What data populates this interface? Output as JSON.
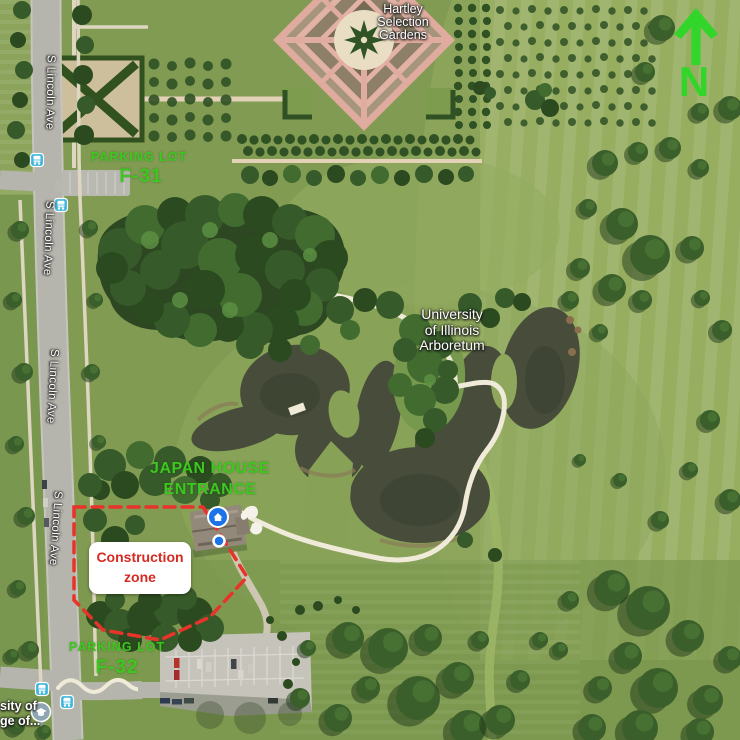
{
  "labels": {
    "hartley": {
      "l1": "Hartley",
      "l2": "Selection",
      "l3": "Gardens"
    },
    "arboretum": {
      "l1": "University",
      "l2": "of Illinois",
      "l3": "Arboretum"
    },
    "streets": [
      "S Lincoln Ave",
      "S Lincoln Ave",
      "S Lincoln Ave",
      "S Lincoln Ave"
    ],
    "parking_f31": {
      "l1": "PARKING LOT",
      "l2": "F-31"
    },
    "parking_f32": {
      "l1": "PARKING LOT",
      "l2": "F-32"
    },
    "japan_house": {
      "l1": "JAPAN HOUSE",
      "l2": "ENTRANCE"
    },
    "construction": {
      "l1": "Construction",
      "l2": "zone"
    },
    "north": "N",
    "clipped_poi": {
      "l1": "sity of",
      "l2": "ge of..."
    }
  },
  "colors": {
    "label_green": "#3cc81e",
    "north_green": "#32d62a",
    "construction_red": "#d62a22",
    "dash_red": "#e8332a",
    "water": "#474d3a",
    "marker_blue": "#1a73e8",
    "transit_teal": "#41b6dc",
    "education_pin": "#8fa5b1"
  }
}
